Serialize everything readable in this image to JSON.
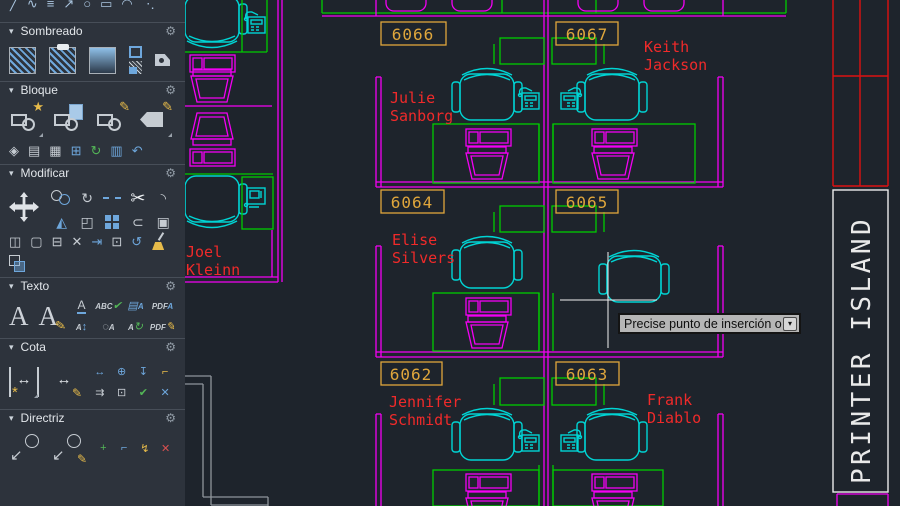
{
  "palette": {
    "sections": [
      {
        "label": "Sombreado"
      },
      {
        "label": "Bloque"
      },
      {
        "label": "Modificar"
      },
      {
        "label": "Texto"
      },
      {
        "label": "Cota"
      },
      {
        "label": "Directriz"
      }
    ]
  },
  "icons": {
    "collapse": "▾",
    "gear": "⚙",
    "dropdown": "▾",
    "line": "╱",
    "wave": "∿",
    "parallel": "≡",
    "arrow": "↗",
    "circle": "○",
    "rect": "▭",
    "arc": "◠",
    "dots": "⋱",
    "star": "★",
    "pencil": "✎",
    "diamond": "◈",
    "table": "▤",
    "save": "▦",
    "plussq": "⊞",
    "refresh": "↻",
    "cells": "▥",
    "undo": "↶",
    "rotate": "↻",
    "scissors": "✂",
    "mirror": "◭",
    "fillet": "◝",
    "sweep": "⊂",
    "box": "▣",
    "select": "◰",
    "offset": "◫",
    "minus": "⊟",
    "square": "▢",
    "cross": "✕",
    "extend": "⇥",
    "align": "⊡",
    "undoarc": "↺",
    "A": "A",
    "ABC": "ABC",
    "check": "✔",
    "PDF": "PDF",
    "updown": "↕",
    "ring": "◌",
    "dimh": "↔",
    "center": "⊕",
    "dimv": "↧",
    "corner": "⌐",
    "arrows2": "⇉",
    "swarrow": "↙",
    "plus": "+",
    "bolt": "↯",
    "spark": "*"
  },
  "canvas": {
    "cubicles": [
      {
        "number": "6066",
        "first": "Julie",
        "last": "Sanborg"
      },
      {
        "number": "6067",
        "first": "Keith",
        "last": "Jackson"
      },
      {
        "number": "6064",
        "first": "Elise",
        "last": "Silvers"
      },
      {
        "number": "6065",
        "first": "",
        "last": ""
      },
      {
        "number": "6062",
        "first": "Jennifer",
        "last": "Schmidt"
      },
      {
        "number": "6063",
        "first": "Frank",
        "last": "Diablo"
      },
      {
        "number": "",
        "first": "Joel",
        "last": "Kleinn"
      }
    ],
    "printer_island_label": "PRINTER ISLAND",
    "tooltip_text": "Precise punto de inserción o"
  },
  "colors": {
    "canvas_bg": "#1e242c",
    "palette_bg": "#2d333c",
    "panel_line": "#474e58",
    "header_text": "#e2e6ea",
    "icon_gray": "#c6ccd2",
    "icon_blue": "#6ea7dc",
    "icon_yellow": "#e7bb4a",
    "icon_green": "#53b657",
    "icon_red": "#d95050",
    "magenta": "#f400f4",
    "green": "#00cc00",
    "cyan": "#00d4d4",
    "orange": "#dfa63c",
    "red_text": "#f02a2a",
    "red_line": "#dd1111",
    "white_line": "#ebebeb",
    "gray_wall": "#8f959b",
    "tooltip_bg": "#b6b6b6"
  }
}
